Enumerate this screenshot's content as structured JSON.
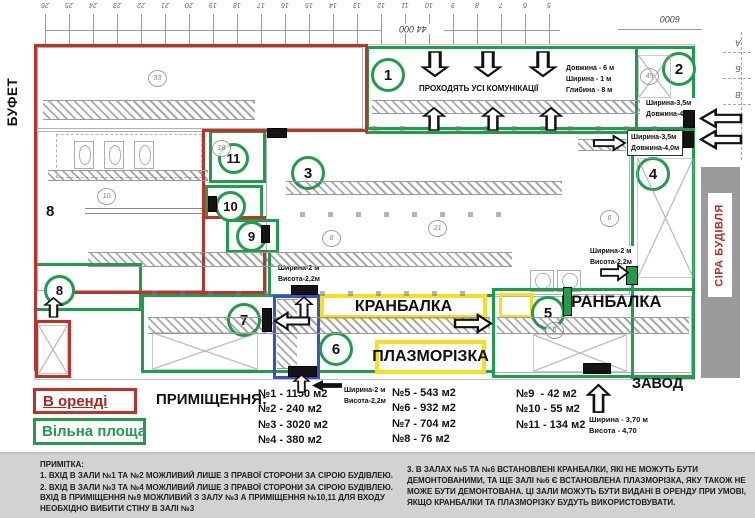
{
  "plan": {
    "side_labels": {
      "buffet": "БУФЕТ",
      "gray_building": "СІРА БУДІВЛЯ",
      "factory": "ЗАВОД"
    },
    "room_markers": [
      "1",
      "2",
      "3",
      "4",
      "5",
      "6",
      "7",
      "8",
      "9",
      "10",
      "11"
    ],
    "hand_mark": "8",
    "annotations": {
      "communications": "ПРОХОДЯТЬ УСІ КОМУНІКАЦІЇ",
      "pit_dims": [
        "Довжина - 6 м",
        "Ширина - 1 м",
        "Глибина - 8 м"
      ],
      "door35_a": [
        "Ширина-3,5м",
        "Довжина-4,0м"
      ],
      "door35_b": [
        "Ширина-3,5м",
        "Довжина-4,0м"
      ],
      "door2_a": [
        "Ширина-2 м",
        "Висота-2,2м"
      ],
      "door2_b": [
        "Ширина-2 м",
        "Висота-2,2м"
      ],
      "door2_c": [
        "Ширина-2 м",
        "Висота-2,2м"
      ],
      "gate_dims": [
        "Ширина - 3,70 м",
        "Висота - 4,70"
      ],
      "crane_1": "КРАНБАЛКА",
      "crane_2": "КРАНБАЛКА",
      "plasma": "ПЛАЗМОРІЗКА"
    },
    "survey": {
      "top_dim": "44 000",
      "corner_dim": "6000",
      "grid_numbers": [
        "26",
        "25",
        "24",
        "23",
        "22",
        "21",
        "20",
        "19",
        "18",
        "17",
        "16",
        "15",
        "14",
        "13",
        "12",
        "11",
        "10",
        "9",
        "8",
        "7",
        "6",
        "5"
      ],
      "row_letters": [
        "А",
        "Б",
        "В"
      ]
    },
    "faint_marks": [
      {
        "t": "33",
        "x": 148,
        "y": 70
      },
      {
        "t": "18",
        "x": 212,
        "y": 140
      },
      {
        "t": "10",
        "x": 97,
        "y": 188
      },
      {
        "t": "8",
        "x": 322,
        "y": 230
      },
      {
        "t": "21",
        "x": 428,
        "y": 220
      },
      {
        "t": "45",
        "x": 640,
        "y": 68
      },
      {
        "t": "8",
        "x": 545,
        "y": 322
      },
      {
        "t": "6",
        "x": 600,
        "y": 210
      }
    ]
  },
  "legend": {
    "rented": "В оренді",
    "free": "Вільна площа"
  },
  "premises": {
    "title": "ПРИМІЩЕННЯ:",
    "col1": [
      "№1 - 1150 м2",
      "№2 - 240 м2",
      "№3 - 3020 м2",
      "№4 - 380 м2"
    ],
    "col2": [
      "№5 - 543 м2",
      "№6 - 932 м2",
      "№7 - 704 м2",
      "№8 - 76 м2"
    ],
    "col3": [
      "№9  - 42 м2",
      "№10 - 55 м2",
      "№11 - 134 м2"
    ]
  },
  "notes": {
    "title": "ПРИМІТКА:",
    "left": [
      "1. ВХІД В ЗАЛИ №1 ТА №2 МОЖЛИВИЙ ЛИШЕ З ПРАВОЇ СТОРОНИ ЗА СІРОЮ БУДІВЛЕЮ.",
      "2. ВХІД В ЗАЛИ №3 ТА №4 МОЖЛИВИЙ ЛИШЕ З ПРАВОЇ СТОРОНИ ЗА СІРОЮ БУДІВЛЕЮ. ВХІД В ПРИМІЩЕННЯ №9 МОЖЛИВИЙ З ЗАЛУ №3 А ПРИМІЩЕННЯ №10,11 ДЛЯ ВХОДУ НЕОБХІДНО ВИБИТИ СТІНУ В ЗАЛІ №3"
    ],
    "right": [
      "3. В ЗАЛАХ №5 ТА №6  ВСТАНОВЛЕНІ КРАНБАЛКИ, ЯКІ НЕ МОЖУТЬ БУТИ ДЕМОНТОВАНИМИ, ТА ЩЕ ЗАЛІ №6 Є ВСТАНОВЛЕНА ПЛАЗМОРІЗКА, ЯКУ ТАКОЖ НЕ МОЖЕ БУТИ ДЕМОНТОВАНА. ЦІ ЗАЛИ МОЖУТЬ БУТИ ВИДАНІ В ОРЕНДУ ПРИ УМОВІ, ЯКЩО КРАНБАЛКИ ТА ПЛАЗМОРІЗКУ БУДУТЬ ВИКОРИСТОВУВАТИ."
    ]
  },
  "colors": {
    "rented": "#c33027",
    "free": "#1e9e4b",
    "corridor": "#3a4fd0",
    "highlight": "#f6df1c",
    "gray_building_text": "#c0251f"
  }
}
